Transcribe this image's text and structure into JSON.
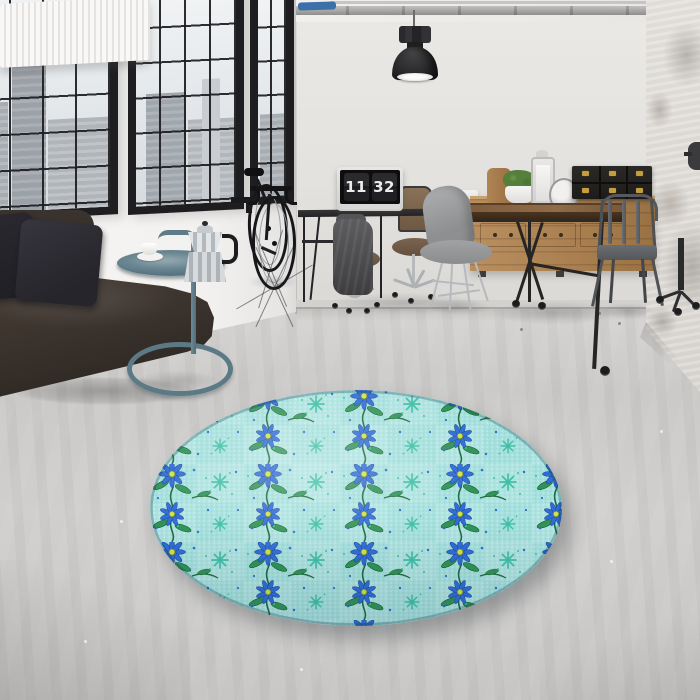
{
  "scene": {
    "type": "interior photograph",
    "description": "Industrial loft living room, daylight: black steel windows with city view, leather sofa, bicycle, office desk with flip-clock screensaver, reclaimed-wood furniture, and a round teal floral rug on a polished concrete floor"
  },
  "monitor_clock": {
    "hours": "11",
    "minutes": "32"
  },
  "palette": {
    "wall": "#f2f1ef",
    "back_wall": "#e4e2df",
    "floor": "#cccbc9",
    "window_frame": "#1e1e20",
    "sofa_leather": "#3a322d",
    "metal_teal": "#5e7c88",
    "wood": "#a97f50",
    "wood_dark": "#4a3420",
    "lamp_black": "#2a2a2c",
    "chrome": "#b7babc",
    "trunk_brass": "#c59d3f",
    "rug_base": "#a6e0dd",
    "rug_blue": "#2f6cd8",
    "rug_green": "#2e9356",
    "rug_vine": "#1d6b40",
    "rug_teal": "#3fc0a6",
    "rug_yellow": "#d3e14e"
  },
  "objects": {
    "room": "Loft living room",
    "windows": "Black steel factory windows with city skyline view",
    "radiator": "White panel radiator",
    "sofa": "Dark brown leather sofa with charcoal cushions",
    "side_table": "Teal metal loop-base tray table",
    "coffee_cup": "White coffee cup and saucer",
    "moka_pot": "Stainless moka espresso pot",
    "bicycle": "Black road bicycle leaning on wall",
    "pendant_lamp": "Black industrial pendant lamp",
    "ceiling_pipes": "Exposed ceiling pipes",
    "desk": "Black metal office desk",
    "monitor": "Monitor showing flip-clock time",
    "coat": "Grey coat draped over office chair",
    "office_chair": "Swivel office chair with casters",
    "sideboard": "Reclaimed wood sideboard with drawers",
    "plant": "Potted green plant",
    "lantern": "White candle lantern",
    "table_clock": "Round silver table clock",
    "trunks": "Black storage trunks with brass clasps",
    "dining_table": "Industrial wood and cast-iron table on casters",
    "shell_chair": "Grey molded shell chair with wire base",
    "metal_chair": "Gunmetal bistro armchair",
    "column": "Distressed plaster column",
    "wall_lamp": "Black wall lamp on column",
    "rug": "Round teal rug with blue daisy and vine pattern",
    "floor": "Polished concrete floor"
  }
}
